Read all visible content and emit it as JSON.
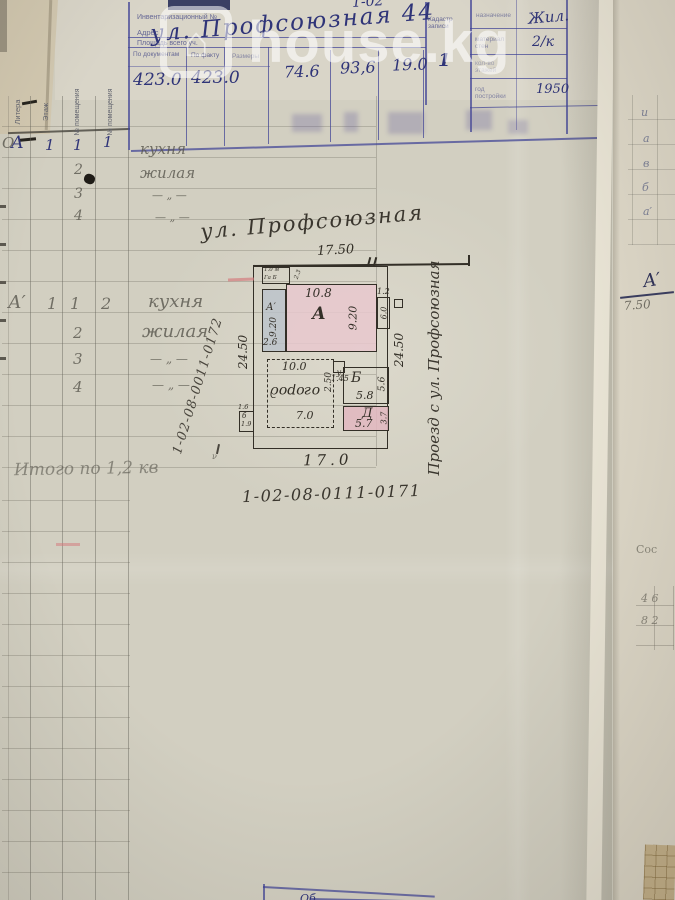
{
  "watermark": {
    "text": "house.kg"
  },
  "header": {
    "inventory_label": "Инвентаризационный №",
    "address_label": "Адрес",
    "area_label": "Площадь всего уч.",
    "top_fragment": "1-02",
    "address_value": "ул. Профсоюзная  44",
    "columns": {
      "by_documents": "По документам",
      "by_fact": "По факту",
      "dimensions": "Размеры"
    },
    "values": {
      "area_by_documents": "423.0",
      "area_by_fact": "423.0",
      "v1": "74.6",
      "v2": "93,6",
      "v3": "19.0",
      "v4": "1"
    },
    "cadastre_label": "Кадастр записи",
    "right_block": {
      "rows": [
        {
          "label": "назначение",
          "value": "Жил."
        },
        {
          "label": "материал стен",
          "value": "2/к"
        },
        {
          "label": "кол-во этажей",
          "value": ""
        },
        {
          "label": "год постройки",
          "value": "1950"
        }
      ]
    }
  },
  "left_table": {
    "col_headers": [
      "Литера",
      "Этаж",
      "№ помещения",
      "№ помещения"
    ],
    "block1": {
      "litera": "А",
      "etazh": "1",
      "rows": [
        {
          "n1": "1",
          "n2": "1",
          "name": "кухня"
        },
        {
          "n1": "2",
          "n2": "",
          "name": "жилая"
        },
        {
          "n1": "3",
          "n2": "",
          "name": "— „ —"
        },
        {
          "n1": "4",
          "n2": "",
          "name": "— „ —"
        }
      ]
    },
    "block2": {
      "litera": "А′",
      "etazh": "1",
      "rows": [
        {
          "n1": "1",
          "n2": "2",
          "name": "кухня"
        },
        {
          "n1": "2",
          "n2": "",
          "name": "жилая"
        },
        {
          "n1": "3",
          "n2": "",
          "name": "— „ —"
        },
        {
          "n1": "4",
          "n2": "",
          "name": "— „ —"
        }
      ]
    },
    "total_note": "Итого по 1,2 кв"
  },
  "plan": {
    "street_label": "ул. Профсоюзная",
    "top_dim": "17.50",
    "bottom_dim": "17.0",
    "left_dim": "24.50",
    "right_dim": "24.50",
    "driveway_label": "Проезд с ул. Профсоюзная",
    "building_a": {
      "label": "А",
      "width": "10.8",
      "height": "9.20"
    },
    "annex_a1": {
      "label": "А′",
      "height": "9.20",
      "width": "2.6"
    },
    "right_annex": {
      "width": "1.2",
      "height": "6.0"
    },
    "corner_note_1": "1.0 м",
    "corner_note_2": "Га Б",
    "corner_note_3": "2.3",
    "garden": {
      "label": "огород",
      "top": "10.0",
      "bottom": "7.0",
      "side": "2.50"
    },
    "gate": {
      "label": "у",
      "dim": "1.45"
    },
    "room_b": {
      "label": "Б",
      "side": "5.6",
      "bottom": "5.8"
    },
    "room_d": {
      "label": "Д",
      "bottom": "5.7",
      "side": "3.7"
    },
    "shed": {
      "top": "1.6",
      "label": "б",
      "dim": "1.9"
    },
    "inv_number_diagonal": "1-02-08-0011-0172",
    "inv_number_bottom": "1-02-08-0111-0171"
  },
  "right_strip": {
    "row_marks": [
      "и",
      "а",
      "в",
      "б",
      "а′"
    ],
    "section_label": "А′",
    "section_dim": "7.50",
    "faint_text": "Сос",
    "grid_marks": [
      "4 6",
      "8 2"
    ]
  },
  "bottom_box": {
    "fragment": "Об"
  },
  "colors": {
    "ink_blue": "#3e4296",
    "plan_ink": "#332f27",
    "building_fill": "#e8c8ce",
    "annex_fill": "#bac2ca",
    "page": "#d2cfc1"
  }
}
